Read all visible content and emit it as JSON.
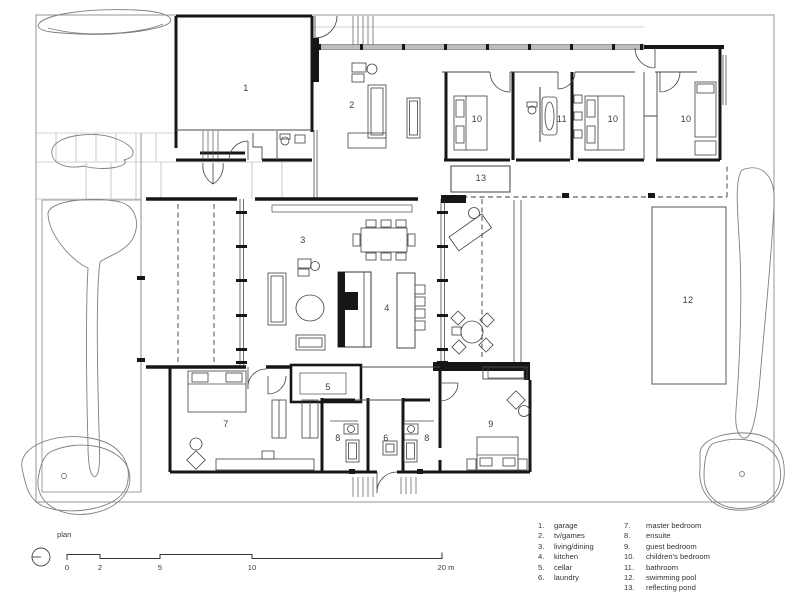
{
  "plan": {
    "name_label": "plan",
    "room_numbers": {
      "garage": "1",
      "tv_games": "2",
      "living_dining": "3",
      "kitchen": "4",
      "cellar": "5",
      "laundry": "6",
      "master_bedroom": "7",
      "ensuite": "8",
      "guest_bedroom": "9",
      "childrens_bedroom": "10",
      "bathroom": "11",
      "swimming_pool": "12",
      "reflecting_pond": "13"
    },
    "scale_bar": {
      "ticks": [
        "0",
        "2",
        "5",
        "10",
        "20 m"
      ]
    }
  },
  "legend": {
    "col1": [
      {
        "num": "1.",
        "label": "garage"
      },
      {
        "num": "2.",
        "label": "tv/games"
      },
      {
        "num": "3.",
        "label": "living/dining"
      },
      {
        "num": "4.",
        "label": "kitchen"
      },
      {
        "num": "5.",
        "label": "cellar"
      },
      {
        "num": "6.",
        "label": "laundry"
      }
    ],
    "col2": [
      {
        "num": "7.",
        "label": "master bedroom"
      },
      {
        "num": "8.",
        "label": "ensuite"
      },
      {
        "num": "9.",
        "label": "guest bedroom"
      },
      {
        "num": "10.",
        "label": "children's bedroom"
      },
      {
        "num": "11.",
        "label": "bathroom"
      },
      {
        "num": "12.",
        "label": "swimming pool"
      },
      {
        "num": "13.",
        "label": "reflecting pond"
      }
    ]
  }
}
